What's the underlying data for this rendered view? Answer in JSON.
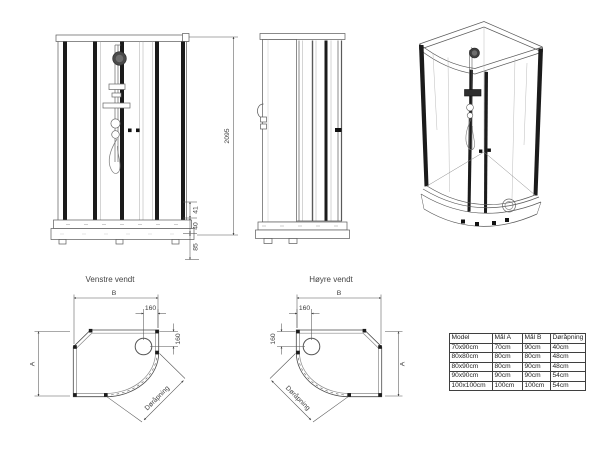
{
  "front_view": {
    "dims": {
      "total_height": "2095",
      "upper": "41",
      "mid": "40",
      "base": "85"
    }
  },
  "plans": {
    "left": {
      "title": "Venstre vendt",
      "width_label": "B",
      "depth_label": "A",
      "drain_offset_x": "160",
      "drain_offset_y": "160",
      "door_label": "Døråpning"
    },
    "right": {
      "title": "Høyre vendt",
      "width_label": "B",
      "depth_label": "A",
      "drain_offset_x": "160",
      "drain_offset_y": "160",
      "door_label": "Døråpning"
    }
  },
  "spec_table": {
    "headers": [
      "Model",
      "Mål A",
      "Mål B",
      "Døråpning"
    ],
    "rows": [
      [
        "70x90cm",
        "70cm",
        "90cm",
        "40cm"
      ],
      [
        "80x80cm",
        "80cm",
        "80cm",
        "48cm"
      ],
      [
        "80x90cm",
        "80cm",
        "90cm",
        "48cm"
      ],
      [
        "90x90cm",
        "90cm",
        "90cm",
        "54cm"
      ],
      [
        "100x100cm",
        "100cm",
        "100cm",
        "54cm"
      ]
    ]
  },
  "colors": {
    "line": "#555555",
    "panel_dark": "#1b1b1b",
    "background": "#ffffff"
  }
}
